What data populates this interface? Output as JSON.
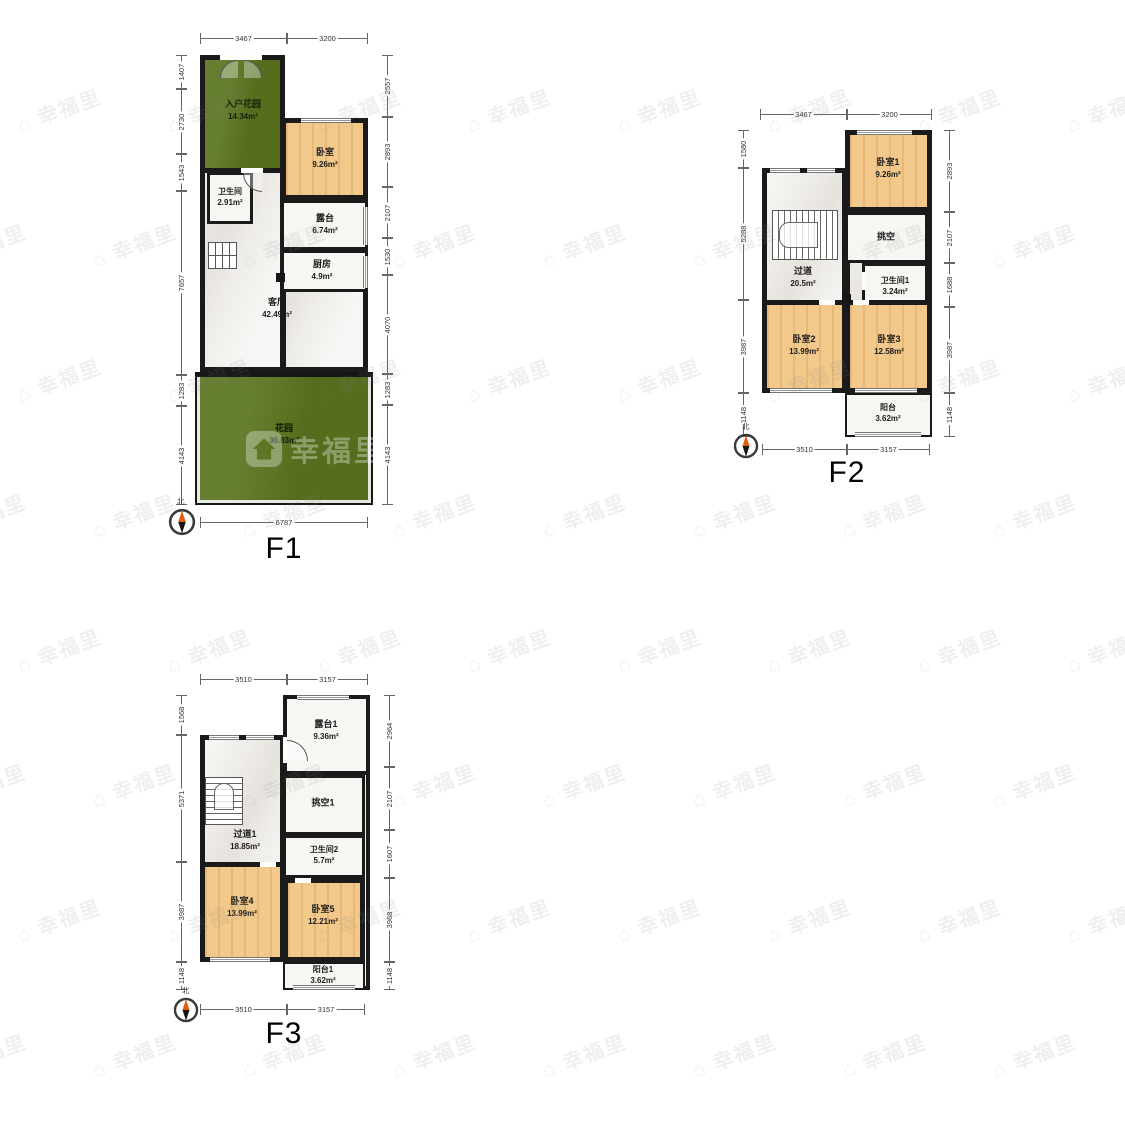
{
  "watermark": {
    "text": "幸福里"
  },
  "compass": {
    "north": "北"
  },
  "f1": {
    "label": "F1",
    "rooms": {
      "entry_garden": {
        "name": "入户花园",
        "area": "14.34m²"
      },
      "bedroom": {
        "name": "卧室",
        "area": "9.26m²"
      },
      "bathroom": {
        "name": "卫生间",
        "area": "2.91m²"
      },
      "terrace": {
        "name": "露台",
        "area": "6.74m²"
      },
      "kitchen": {
        "name": "厨房",
        "area": "4.9m²"
      },
      "living_room": {
        "name": "客厅",
        "area": "42.49m²"
      },
      "garden": {
        "name": "花园",
        "area": "36.83m²"
      }
    },
    "dims": {
      "top": [
        "3467",
        "3200"
      ],
      "bottom": [
        "6787"
      ],
      "left": [
        "1407",
        "2730",
        "1543",
        "7657",
        "1283",
        "4143"
      ],
      "right": [
        "2557",
        "2893",
        "2107",
        "1530",
        "4070",
        "1283",
        "4143"
      ]
    }
  },
  "f2": {
    "label": "F2",
    "rooms": {
      "bedroom1": {
        "name": "卧室1",
        "area": "9.26m²"
      },
      "void": {
        "name": "挑空"
      },
      "bathroom1": {
        "name": "卫生间1",
        "area": "3.24m²"
      },
      "hallway": {
        "name": "过道",
        "area": "20.5m²"
      },
      "bedroom2": {
        "name": "卧室2",
        "area": "13.99m²"
      },
      "bedroom3": {
        "name": "卧室3",
        "area": "12.58m²"
      },
      "balcony": {
        "name": "阳台",
        "area": "3.62m²"
      }
    },
    "dims": {
      "top": [
        "3467",
        "3200"
      ],
      "bottom": [
        "3510",
        "3157"
      ],
      "left": [
        "1580",
        "5288",
        "3987",
        "1148"
      ],
      "right": [
        "2893",
        "2107",
        "1688",
        "3987",
        "1148"
      ]
    }
  },
  "f3": {
    "label": "F3",
    "rooms": {
      "terrace1": {
        "name": "露台1",
        "area": "9.36m²"
      },
      "void1": {
        "name": "挑空1"
      },
      "bathroom2": {
        "name": "卫生间2",
        "area": "5.7m²"
      },
      "hallway1": {
        "name": "过道1",
        "area": "18.85m²"
      },
      "bedroom4": {
        "name": "卧室4",
        "area": "13.99m²"
      },
      "bedroom5": {
        "name": "卧室5",
        "area": "12.21m²"
      },
      "balcony1": {
        "name": "阳台1",
        "area": "3.62m²"
      }
    },
    "dims": {
      "top": [
        "3510",
        "3157"
      ],
      "bottom": [
        "3510",
        "3157"
      ],
      "left": [
        "1568",
        "5371",
        "3987",
        "1148"
      ],
      "right": [
        "2964",
        "2107",
        "1607",
        "3968",
        "1148"
      ]
    }
  }
}
